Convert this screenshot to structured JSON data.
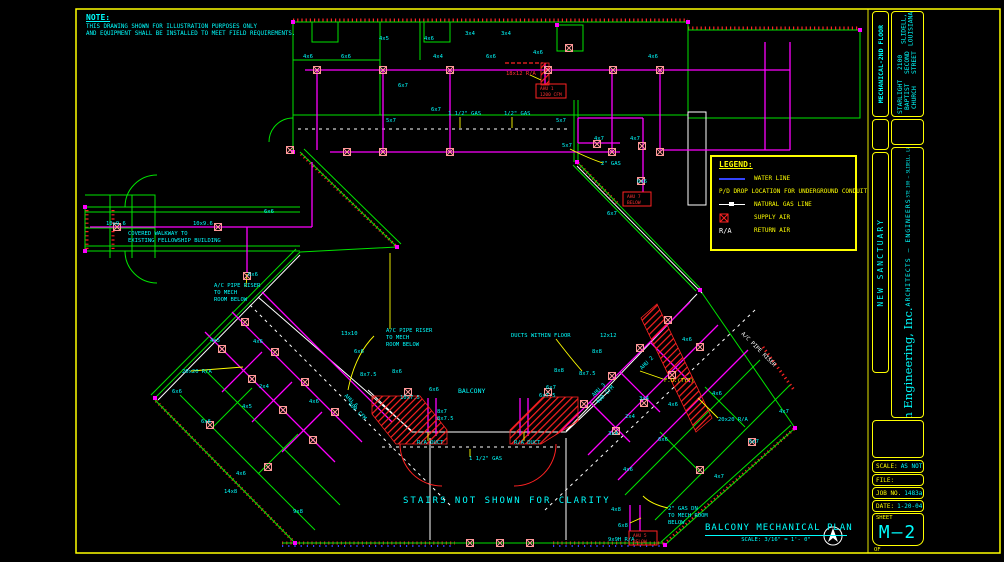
{
  "colors": {
    "background": "#000000",
    "border": "#ffff00",
    "text": "#00ffff",
    "walls": "#00e400",
    "ducts": "#ff00ff",
    "supply_air": "#ff2222",
    "water_line": "#3344ff",
    "diffuser": "#ff9999"
  },
  "note": {
    "title": "NOTE:",
    "lines": [
      "THIS DRAWING SHOWN FOR ILLUSTRATION PURPOSES ONLY",
      "AND EQUIPMENT SHALL BE INSTALLED TO MEET FIELD REQUIREMENTS."
    ]
  },
  "legend": {
    "title": "LEGEND:",
    "water_line": "WATER LINE",
    "pd_drop": "P/D DROP LOCATION FOR UNDERGROUND CONDUIT",
    "gas_line": "NATURAL GAS LINE",
    "supply_air": "SUPPLY AIR",
    "ra_symbol": "R/A",
    "return_air": "RETURN AIR"
  },
  "footer": {
    "stairs_note": "STAIRS NOT SHOWN FOR CLARITY",
    "plan_title": "BALCONY MECHANICAL PLAN",
    "plan_scale": "SCALE: 3/16\" = 1'- 0\""
  },
  "titleblock": {
    "sheet_title": "MECHANICAL-2ND FLOOR",
    "project": [
      "STARLIGHT BAPTIST CHURCH",
      "2100 SECOND STREET",
      "SLIDELL, LOUISIANA"
    ],
    "project_name": "NEW SANCTUARY",
    "firm": "Dammon Engineering, Inc.",
    "firm_sub": "ARCHITECTS — ENGINEERS",
    "firm_addr1": "STE 100 — SLIDELL, LA 70458",
    "firm_addr2": "DAMMONENG.COM",
    "scale_label": "SCALE:",
    "scale_value": "AS NOTED",
    "file_label": "FILE:",
    "job_label": "JOB NO.",
    "job_value": "1483a",
    "date_label": "DATE:",
    "date_value": "1-20-04",
    "sheet_label": "SHEET",
    "sheet_number": "M—2",
    "of_label": "OF"
  },
  "plan": {
    "labels": [
      {
        "t": "3x4",
        "x": 465,
        "y": 35
      },
      {
        "t": "3x4",
        "x": 501,
        "y": 35
      },
      {
        "t": "4x5",
        "x": 379,
        "y": 40
      },
      {
        "t": "4x6",
        "x": 424,
        "y": 40
      },
      {
        "t": "4x6",
        "x": 303,
        "y": 58
      },
      {
        "t": "6x6",
        "x": 341,
        "y": 58
      },
      {
        "t": "4x4",
        "x": 433,
        "y": 58
      },
      {
        "t": "6x6",
        "x": 486,
        "y": 58
      },
      {
        "t": "4x6",
        "x": 533,
        "y": 54
      },
      {
        "t": "4x6",
        "x": 648,
        "y": 58
      },
      {
        "t": "6x7",
        "x": 398,
        "y": 87
      },
      {
        "t": "5x7",
        "x": 386,
        "y": 122
      },
      {
        "t": "5x7",
        "x": 556,
        "y": 122
      },
      {
        "t": "6x7",
        "x": 431,
        "y": 111
      },
      {
        "t": "18x12 R/A",
        "x": 506,
        "y": 75,
        "c": "#ff3333"
      },
      {
        "t": "1 1/2\" GAS",
        "x": 448,
        "y": 115
      },
      {
        "t": "1/2\" GAS",
        "x": 504,
        "y": 115
      },
      {
        "t": "5x7",
        "x": 562,
        "y": 147
      },
      {
        "t": "4x7",
        "x": 594,
        "y": 140
      },
      {
        "t": "4x7",
        "x": 630,
        "y": 140
      },
      {
        "t": "2\" GAS",
        "x": 601,
        "y": 165
      },
      {
        "t": "6x6",
        "x": 637,
        "y": 183
      },
      {
        "t": "6x7",
        "x": 607,
        "y": 215
      },
      {
        "t": "10x9.6",
        "x": 106,
        "y": 225
      },
      {
        "t": "10x9.6",
        "x": 193,
        "y": 225
      },
      {
        "t": "6x6",
        "x": 264,
        "y": 213
      },
      {
        "t": "6x6",
        "x": 248,
        "y": 276
      },
      {
        "t": "COVERED WALKWAY TO",
        "x": 128,
        "y": 235
      },
      {
        "t": "EXISTING FELLOWSHIP BUILDING",
        "x": 128,
        "y": 242
      },
      {
        "t": "A/C PIPE RISER",
        "x": 214,
        "y": 287
      },
      {
        "t": "TO MECH",
        "x": 214,
        "y": 294
      },
      {
        "t": "ROOM BELOW",
        "x": 214,
        "y": 301
      },
      {
        "t": "A/C PIPE RISER",
        "x": 386,
        "y": 332
      },
      {
        "t": "TO MECH",
        "x": 386,
        "y": 339
      },
      {
        "t": "ROOM BELOW",
        "x": 386,
        "y": 346
      },
      {
        "t": "13x10",
        "x": 341,
        "y": 335
      },
      {
        "t": "6x6",
        "x": 354,
        "y": 353
      },
      {
        "t": "8x6",
        "x": 392,
        "y": 373
      },
      {
        "t": "8x7.5",
        "x": 360,
        "y": 376
      },
      {
        "t": "6x6",
        "x": 429,
        "y": 391
      },
      {
        "t": "10x7.5",
        "x": 400,
        "y": 399
      },
      {
        "t": "8x7",
        "x": 437,
        "y": 413
      },
      {
        "t": "8x7.5",
        "x": 437,
        "y": 420
      },
      {
        "t": "BALCONY",
        "x": 458,
        "y": 393,
        "s": 6.5
      },
      {
        "t": "DUCTS WITHIN FLOOR",
        "x": 511,
        "y": 337
      },
      {
        "t": "12x12",
        "x": 600,
        "y": 337
      },
      {
        "t": "8x8",
        "x": 592,
        "y": 353
      },
      {
        "t": "8x8",
        "x": 554,
        "y": 372
      },
      {
        "t": "8x7.5",
        "x": 579,
        "y": 375
      },
      {
        "t": "6x7",
        "x": 546,
        "y": 389
      },
      {
        "t": "6x7.5",
        "x": 539,
        "y": 397
      },
      {
        "t": "4x6",
        "x": 682,
        "y": 341
      },
      {
        "t": "AHU 3",
        "x": 594,
        "y": 397,
        "r": -45
      },
      {
        "t": "400 CFM",
        "x": 598,
        "y": 404,
        "r": -45
      },
      {
        "t": "AHU 2",
        "x": 642,
        "y": 370,
        "r": -45
      },
      {
        "t": "F.U.(TYP)",
        "x": 664,
        "y": 382,
        "c": "#ffff00"
      },
      {
        "t": "AHU 6",
        "x": 344,
        "y": 396,
        "r": 45
      },
      {
        "t": "400 CFM",
        "x": 348,
        "y": 404,
        "r": 45
      },
      {
        "t": "20x20 R/A",
        "x": 182,
        "y": 373
      },
      {
        "t": "4x5",
        "x": 210,
        "y": 342
      },
      {
        "t": "4x6",
        "x": 253,
        "y": 343
      },
      {
        "t": "2x4",
        "x": 259,
        "y": 388
      },
      {
        "t": "6x6",
        "x": 172,
        "y": 393
      },
      {
        "t": "6x6",
        "x": 201,
        "y": 423
      },
      {
        "t": "4x5",
        "x": 242,
        "y": 408
      },
      {
        "t": "4x6",
        "x": 309,
        "y": 403
      },
      {
        "t": "4x6",
        "x": 236,
        "y": 475
      },
      {
        "t": "14x8",
        "x": 224,
        "y": 493
      },
      {
        "t": "9x8",
        "x": 293,
        "y": 513
      },
      {
        "t": "20x20 R/A",
        "x": 718,
        "y": 421
      },
      {
        "t": "3x4",
        "x": 639,
        "y": 400
      },
      {
        "t": "2x4",
        "x": 625,
        "y": 418
      },
      {
        "t": "3x4",
        "x": 608,
        "y": 435
      },
      {
        "t": "4x6",
        "x": 668,
        "y": 406
      },
      {
        "t": "4x6",
        "x": 712,
        "y": 395
      },
      {
        "t": "6x6",
        "x": 658,
        "y": 441
      },
      {
        "t": "4x7",
        "x": 779,
        "y": 413
      },
      {
        "t": "6x7",
        "x": 749,
        "y": 443
      },
      {
        "t": "4x7",
        "x": 714,
        "y": 478
      },
      {
        "t": "4x6",
        "x": 623,
        "y": 471
      },
      {
        "t": "4x8",
        "x": 611,
        "y": 511
      },
      {
        "t": "6x8",
        "x": 618,
        "y": 527
      },
      {
        "t": "2\" GAS DN",
        "x": 668,
        "y": 510
      },
      {
        "t": "TO MECH ROOM",
        "x": 668,
        "y": 517
      },
      {
        "t": "BELOW",
        "x": 668,
        "y": 524
      },
      {
        "t": "9x9H R/A",
        "x": 608,
        "y": 541
      },
      {
        "t": "R/A DUCT",
        "x": 417,
        "y": 444
      },
      {
        "t": "R/A DUCT",
        "x": 514,
        "y": 444
      },
      {
        "t": "1 1/2\" GAS",
        "x": 469,
        "y": 460
      },
      {
        "t": "A/C PIPE RISER",
        "x": 741,
        "y": 334,
        "c": "#ffffff",
        "r": 45
      },
      {
        "t": "AHU 1",
        "x": 540,
        "y": 90,
        "c": "#ff3333",
        "s": 4.5
      },
      {
        "t": "1200 CFM",
        "x": 540,
        "y": 96,
        "c": "#ff3333",
        "s": 4.5
      },
      {
        "t": "AHU 7",
        "x": 627,
        "y": 198,
        "c": "#ff3333",
        "s": 4.5
      },
      {
        "t": "BELOW",
        "x": 627,
        "y": 204,
        "c": "#ff3333",
        "s": 4.5
      },
      {
        "t": "AHU 5",
        "x": 633,
        "y": 537,
        "c": "#ff3333",
        "s": 4.5
      },
      {
        "t": "BELOW",
        "x": 633,
        "y": 543,
        "c": "#ff3333",
        "s": 4.5
      }
    ],
    "diffusers": [
      [
        317,
        70
      ],
      [
        383,
        70
      ],
      [
        450,
        70
      ],
      [
        548,
        70
      ],
      [
        613,
        70
      ],
      [
        660,
        70
      ],
      [
        290,
        150
      ],
      [
        347,
        152
      ],
      [
        383,
        152
      ],
      [
        450,
        152
      ],
      [
        612,
        152
      ],
      [
        660,
        152
      ],
      [
        569,
        48
      ],
      [
        597,
        144
      ],
      [
        642,
        146
      ],
      [
        641,
        181
      ],
      [
        117,
        227
      ],
      [
        218,
        227
      ],
      [
        247,
        276
      ],
      [
        222,
        349
      ],
      [
        252,
        379
      ],
      [
        283,
        410
      ],
      [
        313,
        440
      ],
      [
        245,
        322
      ],
      [
        275,
        352
      ],
      [
        305,
        382
      ],
      [
        335,
        412
      ],
      [
        210,
        425
      ],
      [
        268,
        467
      ],
      [
        668,
        320
      ],
      [
        640,
        348
      ],
      [
        612,
        376
      ],
      [
        584,
        404
      ],
      [
        700,
        347
      ],
      [
        672,
        375
      ],
      [
        644,
        403
      ],
      [
        616,
        431
      ],
      [
        700,
        470
      ],
      [
        752,
        442
      ],
      [
        470,
        543
      ],
      [
        500,
        543
      ],
      [
        530,
        543
      ],
      [
        408,
        392
      ],
      [
        548,
        392
      ]
    ]
  }
}
